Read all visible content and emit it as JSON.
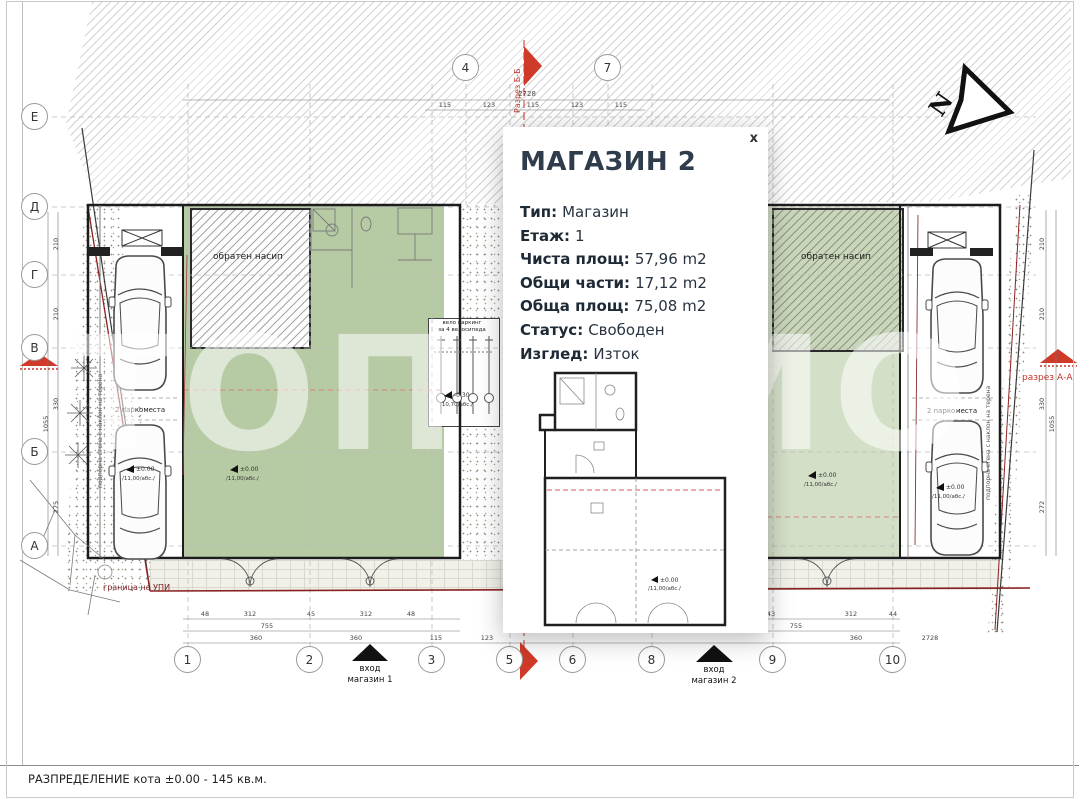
{
  "popup": {
    "title": "МАГАЗИН 2",
    "close": "x",
    "fields": [
      {
        "label": "Тип:",
        "value": "Магазин"
      },
      {
        "label": "Етаж:",
        "value": "1"
      },
      {
        "label": "Чиста площ:",
        "value": "57,96 m2"
      },
      {
        "label": "Общи части:",
        "value": "17,12 m2"
      },
      {
        "label": "Обща площ:",
        "value": "75,08 m2"
      },
      {
        "label": "Статус:",
        "value": "Свободен"
      },
      {
        "label": "Изглед:",
        "value": "Изток"
      }
    ]
  },
  "grid": {
    "rows": [
      "Е",
      "Д",
      "Г",
      "В",
      "Б",
      "А"
    ],
    "top_cols": [
      "4",
      "7"
    ],
    "bottom_cols": [
      "1",
      "2",
      "3",
      "5",
      "6",
      "8",
      "9",
      "10"
    ]
  },
  "labels": {
    "section_bb": "Разрез Б-Б",
    "section_aa": "разрез А-А",
    "north": "N",
    "backfill": "обратен насип",
    "bike_line1": "вело паркинг",
    "bike_line2": "за 4 велосипеда",
    "parking": "2 паркоместа",
    "entrance_word": "вход",
    "shop1": "магазин 1",
    "shop2": "магазин 2",
    "upi_boundary": "граница на УПИ",
    "retaining_wall": "подпорна стена с наклон на терена",
    "footer": "РАЗПРЕДЕЛЕНИЕ кота ±0.00 - 145 кв.м.",
    "watermark": "ТОП ИМО"
  },
  "elevations": {
    "zero": "±0.00",
    "abs11": "/11,00/абс./",
    "minus": "-0.30",
    "abs1070": "/10,70/абс./"
  },
  "dims": {
    "top_total": "2728",
    "top_segs": [
      "115",
      "123",
      "115",
      "123",
      "115"
    ],
    "b1_left": [
      "48",
      "312",
      "45",
      "312",
      "48"
    ],
    "b1_right": [
      "43",
      "312",
      "44"
    ],
    "b2_left": "755",
    "b2_right": "755",
    "b3_left": [
      "360",
      "360",
      "115",
      "123"
    ],
    "b3_right": "360",
    "b_total": "2728",
    "left_v": [
      "210",
      "210",
      "330",
      "275",
      "1055"
    ],
    "right_v": [
      "210",
      "210",
      "330",
      "272",
      "1055"
    ]
  }
}
